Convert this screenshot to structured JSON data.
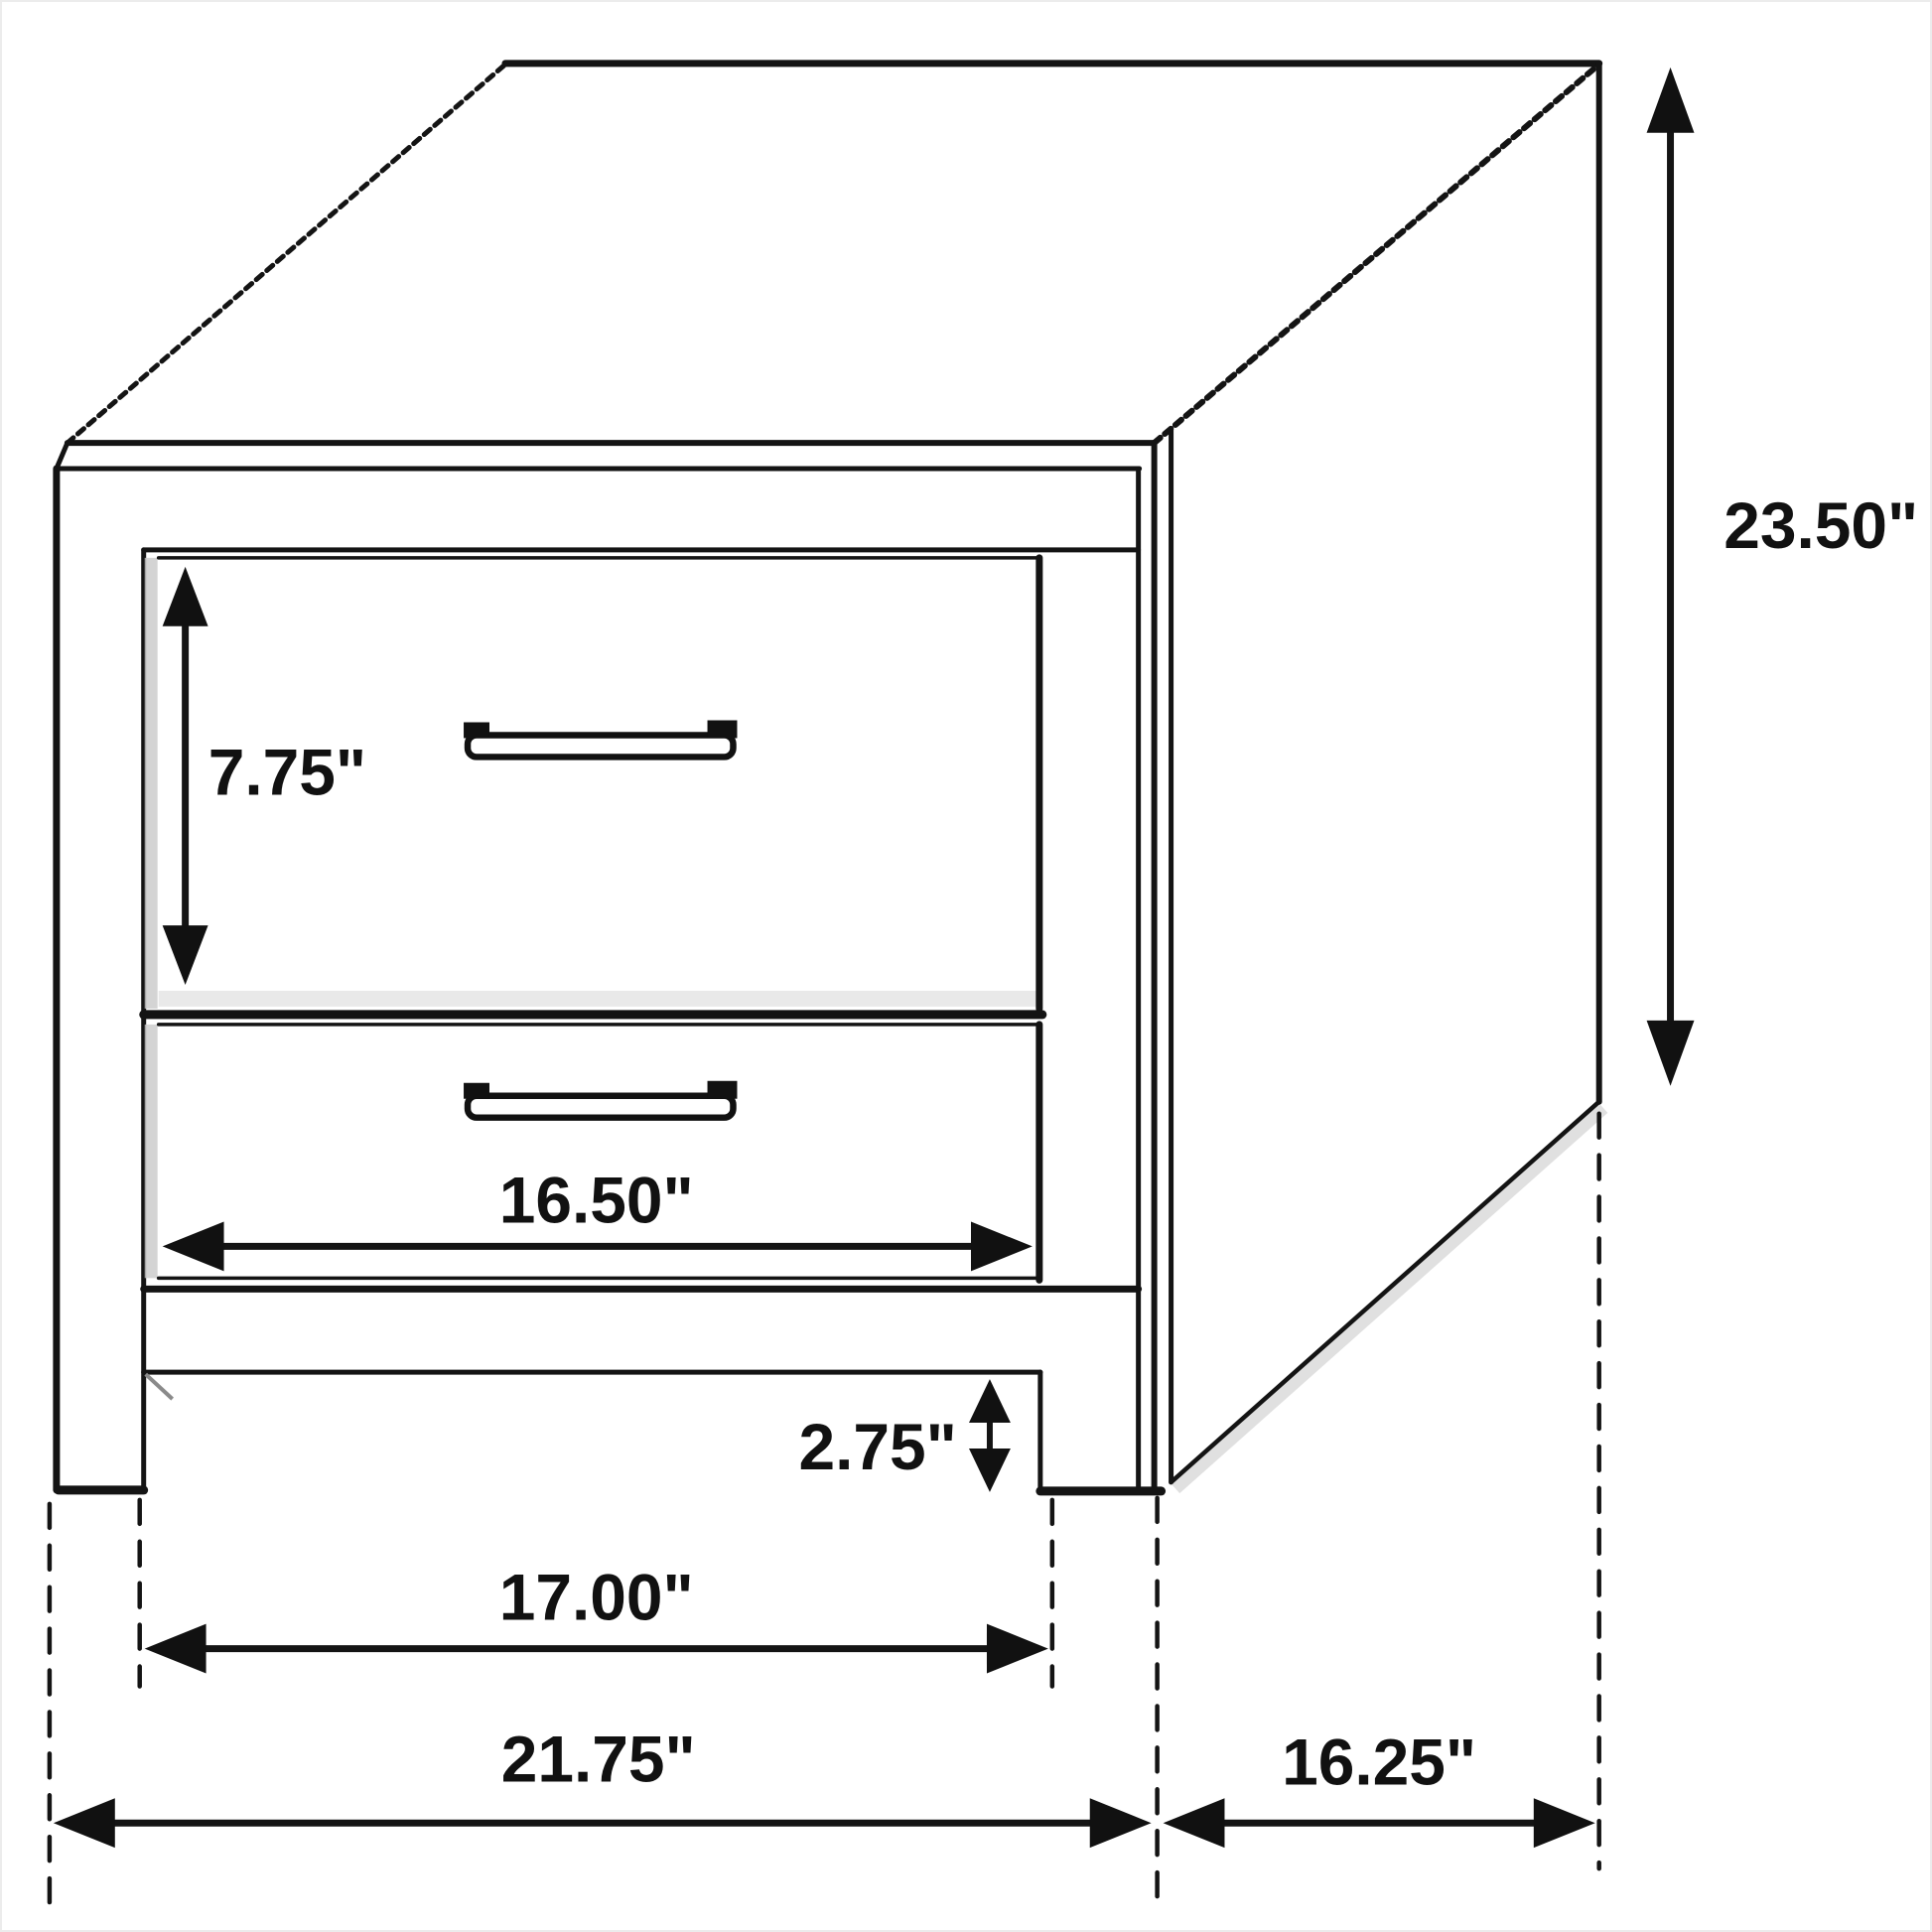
{
  "page": {
    "background": "#ffffff",
    "border_color": "#ececec"
  },
  "diagram": {
    "subject": "two-drawer nightstand isometric line drawing",
    "ink_color": "#141414",
    "dimensions": {
      "drawer_height": {
        "label": "7.75\""
      },
      "overall_height": {
        "label": "23.50\""
      },
      "drawer_width": {
        "label": "16.50\""
      },
      "base_clearance": {
        "label": "2.75\""
      },
      "inner_width": {
        "label": "17.00\""
      },
      "overall_width": {
        "label": "21.75\""
      },
      "depth": {
        "label": "16.25\""
      }
    }
  }
}
